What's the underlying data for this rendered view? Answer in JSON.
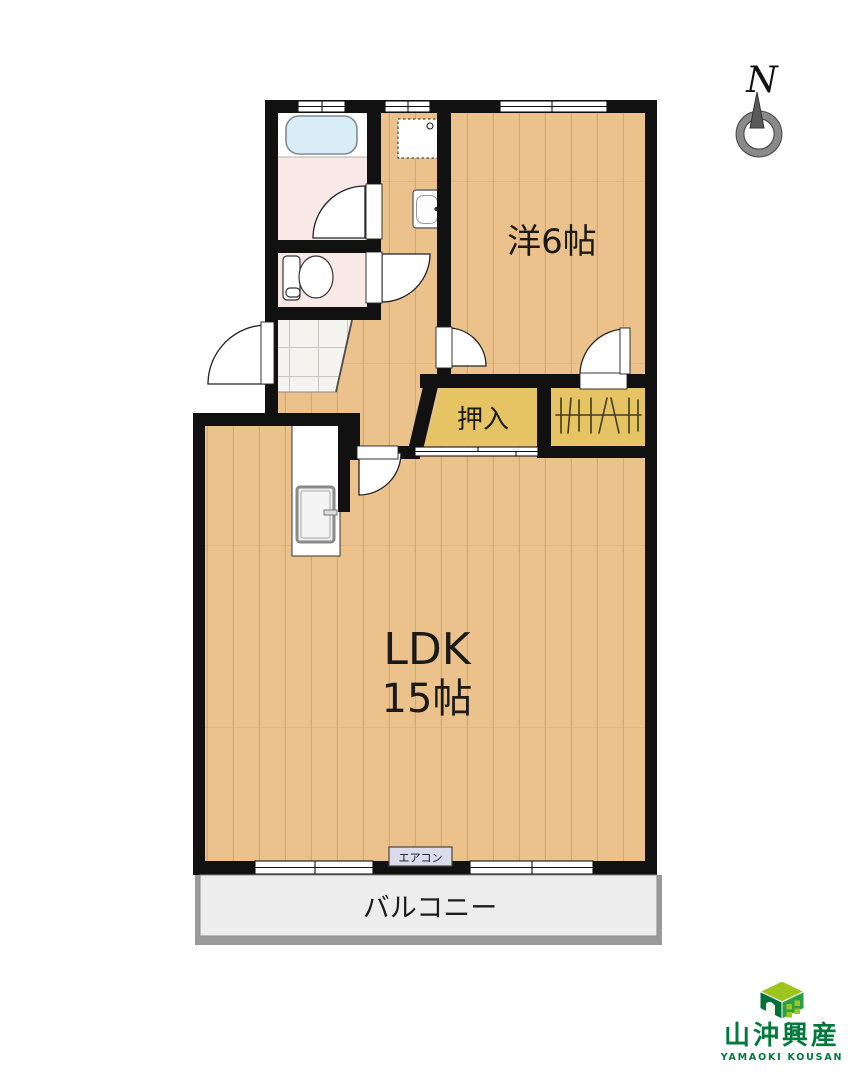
{
  "compass": {
    "label": "N"
  },
  "plan": {
    "rooms": {
      "western_room": {
        "label": "洋6帖"
      },
      "ldk": {
        "line1": "LDK",
        "line2": "15帖"
      },
      "oshiire": {
        "label": "押入"
      },
      "balcony": {
        "label": "バルコニー"
      }
    },
    "aircon_label": "エアコン"
  },
  "logo": {
    "company_ja": "山沖興産",
    "company_en": "YAMAOKI KOUSAN"
  },
  "colors": {
    "wall": "#111111",
    "wood": "#ecc28c",
    "wood_grain": "#d4a873",
    "closet": "#e6c464",
    "service_pink": "#f8e9e7",
    "bathtub_blue": "#d9edf7",
    "tile": "#f4f3f0",
    "tile_line": "#c9c6c0",
    "balcony_fill": "#ededed",
    "balcony_frame": "#9a9a9a",
    "aircon_box": "#dbdbec",
    "logo_green": "#00793c",
    "logo_cube_top": "#9ec51d",
    "logo_cube_left": "#00713a",
    "logo_cube_right": "#2f9e41",
    "compass_gray": "#8a8a8a",
    "compass_needle": "#5a5a5a"
  }
}
